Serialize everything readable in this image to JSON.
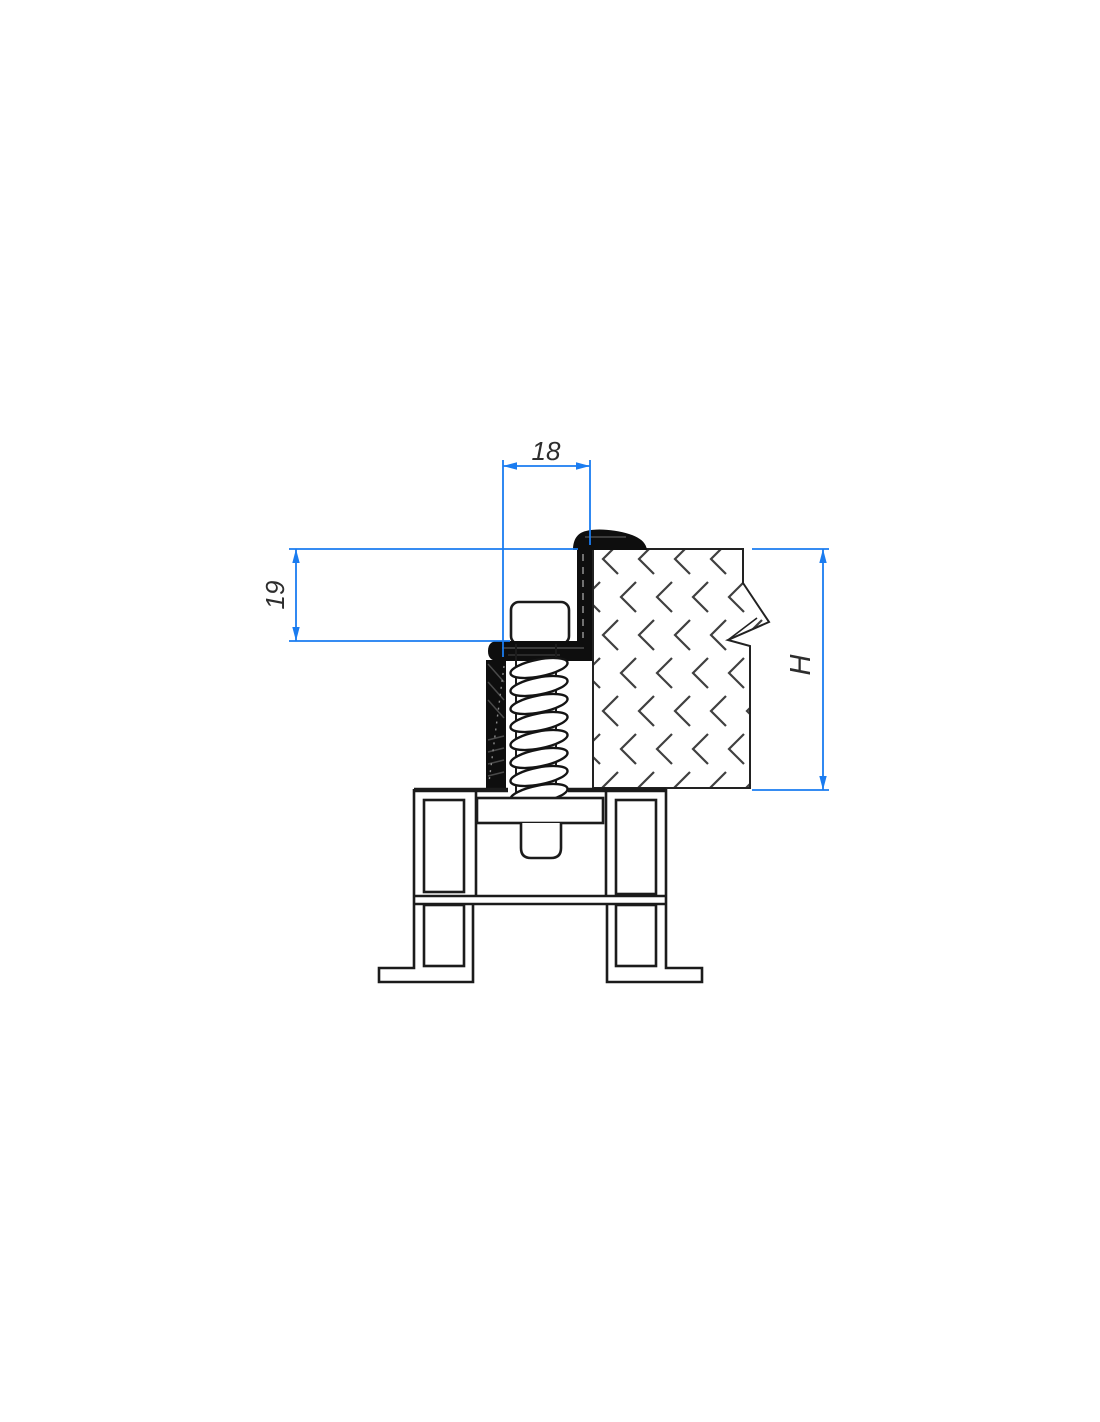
{
  "drawing": {
    "background": "#ffffff",
    "colors": {
      "dimension_line": "#1a7cf0",
      "dimension_text": "#2d2d2d",
      "outline": "#1b1b1b",
      "seal_fill": "#0e0e0e",
      "hatch": "#404040"
    },
    "dimensions": {
      "top_width": {
        "label": "18"
      },
      "left_height": {
        "label": "19"
      },
      "right_height": {
        "label": "H"
      }
    }
  }
}
